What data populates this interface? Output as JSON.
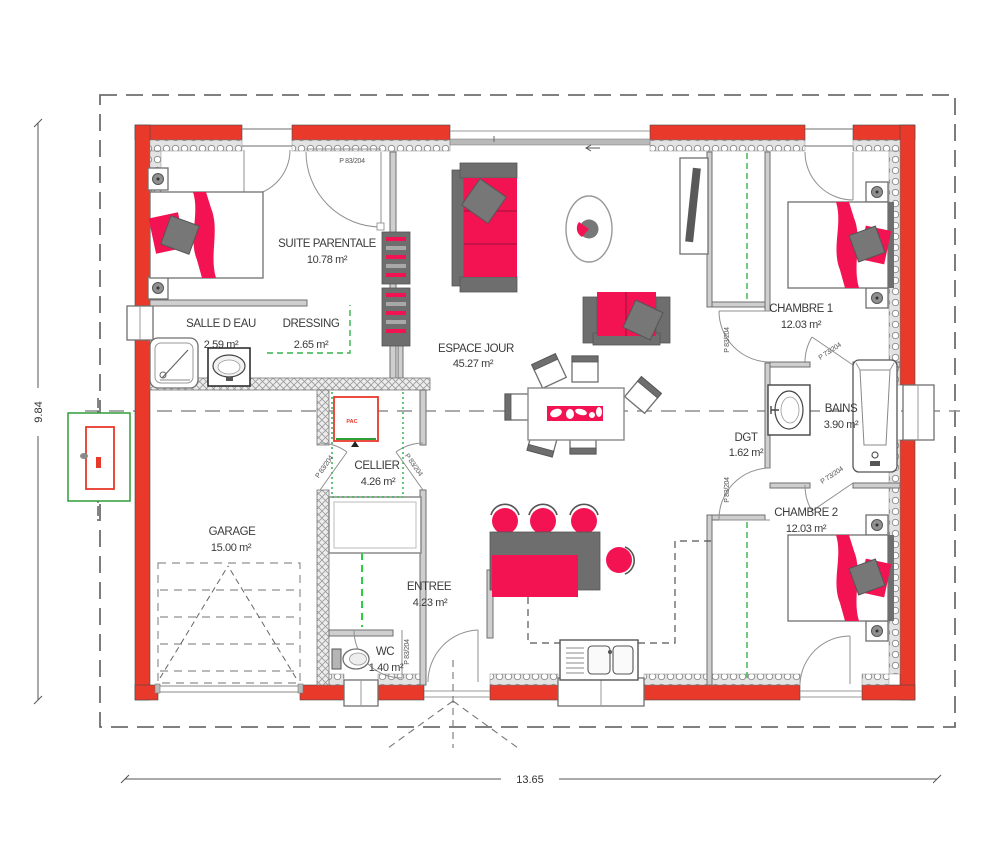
{
  "rooms": {
    "suite": {
      "name": "SUITE PARENTALE",
      "area": "10.78 m²"
    },
    "salle_eau": {
      "name": "SALLE D EAU",
      "area": "2.59 m²"
    },
    "dressing": {
      "name": "DRESSING",
      "area": "2.65 m²"
    },
    "espace": {
      "name": "ESPACE JOUR",
      "area": "45.27 m²"
    },
    "cellier": {
      "name": "CELLIER",
      "area": "4.26 m²"
    },
    "garage": {
      "name": "GARAGE",
      "area": "15.00 m²"
    },
    "entree": {
      "name": "ENTREE",
      "area": "4.23 m²"
    },
    "wc": {
      "name": "WC",
      "area": "1.40 m²"
    },
    "dgt": {
      "name": "DGT",
      "area": "1.62 m²"
    },
    "chambre1": {
      "name": "CHAMBRE 1",
      "area": "12.03 m²"
    },
    "bains": {
      "name": "BAINS",
      "area": "3.90 m²"
    },
    "chambre2": {
      "name": "CHAMBRE 2",
      "area": "12.03 m²"
    }
  },
  "door_labels": {
    "suite": "P 83/204",
    "chambre1": "P 83/204",
    "chambre2": "P 83/204",
    "bains_top": "P 73/204",
    "bains_bottom": "P 73/204",
    "cellier_left": "P 83/204",
    "cellier_right": "P 83/204",
    "wc": "P 83/204"
  },
  "dimensions": {
    "width_m": "13.65",
    "height_m": "9.84"
  },
  "equipment": {
    "heat_pump": "PAC"
  },
  "colors": {
    "wall_red": "#e8392b",
    "furniture_red": "#f31353",
    "furniture_gray": "#6e6e6e",
    "green_dash": "#35b44a",
    "line_gray": "#8a8a8a"
  }
}
